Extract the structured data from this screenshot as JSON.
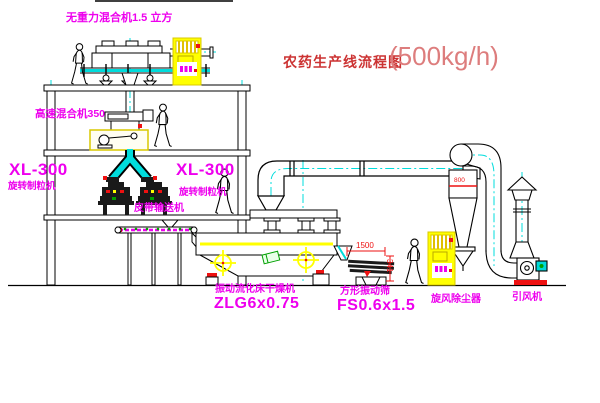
{
  "title": {
    "text": "农药生产线流程图",
    "capacity": "(500kg/h)"
  },
  "equipment": {
    "gravity_mixer": {
      "label": "无重力混合机1.5 立方"
    },
    "high_speed_mixer": {
      "label": "高速混合机350"
    },
    "granulator_left": {
      "model": "XL-300",
      "label": "旋转制粒机"
    },
    "granulator_right": {
      "model": "XL-300",
      "label": "旋转制粒机"
    },
    "belt_conveyor": {
      "label": "皮带输送机"
    },
    "fluid_bed_dryer": {
      "label": "振动流化床干燥机",
      "model": "ZLG6x0.75"
    },
    "square_sieve": {
      "label": "方形振动筛",
      "model": "FS0.6x1.5"
    },
    "cyclone": {
      "label": "旋风除尘器"
    },
    "draft_fan": {
      "label": "引风机"
    }
  },
  "dimensions": {
    "sieve_length": "1500",
    "sieve_height": "341",
    "cyclone_diameter": "800"
  },
  "colors": {
    "label_magenta": "#ee00ee",
    "title_red": "#cc3333",
    "title_number_red": "#dd7d7d",
    "pipe_cyan": "#00dcdc",
    "machine_yellow": "#ffff00",
    "accent_red": "#ee1111",
    "accent_green": "#00a000",
    "line_black": "#000000"
  }
}
